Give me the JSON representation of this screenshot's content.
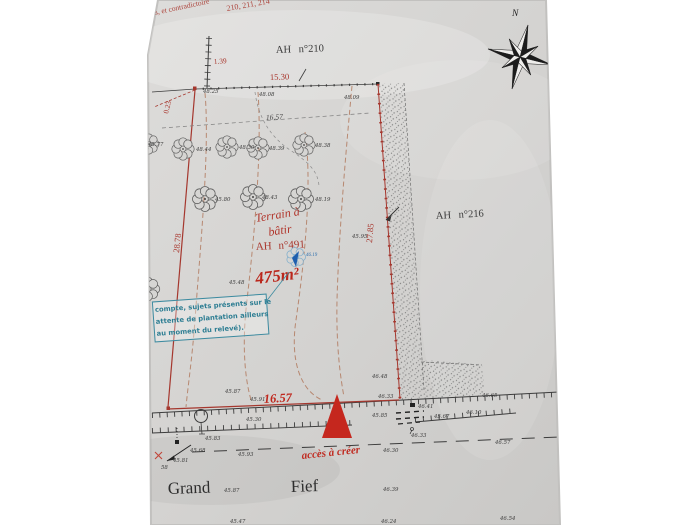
{
  "colors": {
    "paper": "#d6d5d3",
    "ink": "#3c3c3c",
    "boundary_red": "#a5372e",
    "highlight_red": "#c0261c",
    "note_teal": "#2e7e93",
    "contour_sienna": "#b27a5f",
    "marker_blue": "#2f6fae"
  },
  "notes": {
    "line1": "els, et contradictoire",
    "line2": "210, 211, 214"
  },
  "parcels": {
    "top": "AH n°210",
    "right": "AH n°216",
    "main": {
      "label_line1": "Terrain à",
      "label_line2": "bâtir",
      "number": "AH n°491",
      "area": "475m²"
    }
  },
  "dimensions": {
    "top_offset": "1.39",
    "top_width": "15.30",
    "left_offset": "0.23",
    "inner_width": "16.57",
    "left_length": "28.78",
    "right_length": "27.85",
    "frontage": "16.57"
  },
  "annotations": {
    "access": "accès à créer",
    "blue_spot": "46.19",
    "note_box": {
      "line1": "compte, sujets présents sur le",
      "line2": "attente de plantation ailleurs",
      "line3": "au moment du relevé)."
    }
  },
  "street": {
    "word1": "Grand",
    "word2": "Fief"
  },
  "compass": {
    "north_label": "N"
  },
  "spots": [
    "48.25",
    "48.08",
    "48.09",
    "45.77",
    "48.44",
    "48.30",
    "48.39",
    "48.38",
    "45.80",
    "48.43",
    "48.19",
    "45.95",
    "45.48",
    "46.48",
    "46.33",
    "46.65",
    "46.41",
    "45.85",
    "45.67",
    "46.10",
    "46.33",
    "45.87",
    "45.91",
    "45.30",
    "45.83",
    "45.68",
    "45.81",
    "58",
    "45.93",
    "46.30",
    "46.57",
    "45.87",
    "46.39",
    "45.47",
    "46.24",
    "46.54"
  ]
}
